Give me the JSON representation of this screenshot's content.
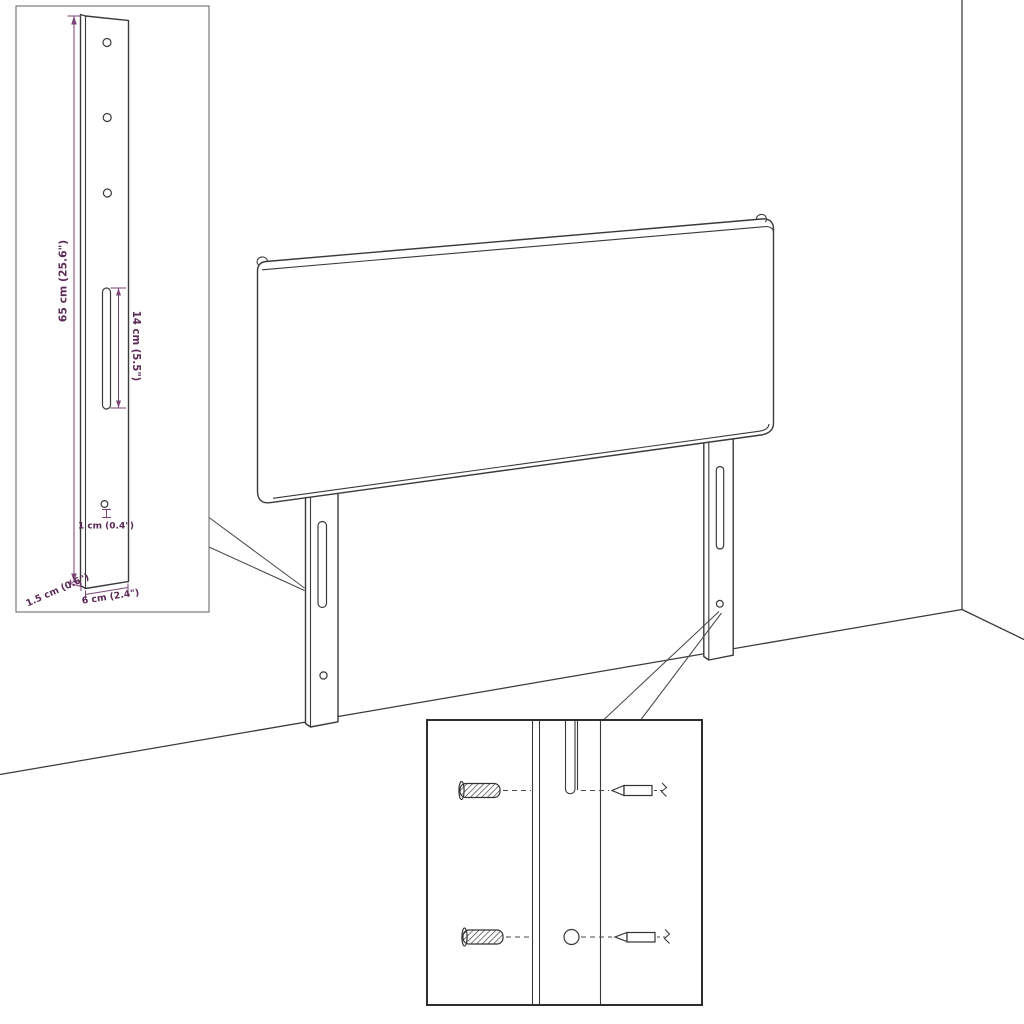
{
  "figure": {
    "kind": "headboard wall-mount dimension diagram",
    "colors": {
      "background": "#ffffff",
      "drawing_line": "#3a3a3a",
      "dimension_line": "#7d4677",
      "dimension_text": "#5b2a56"
    },
    "dims": {
      "height": "65 cm (25.6\")",
      "slot": "14 cm (5.5\")",
      "hole": "1 cm (0.4\")",
      "thickness": "1.5 cm (0.6\")",
      "width": "6 cm (2.4\")"
    }
  }
}
